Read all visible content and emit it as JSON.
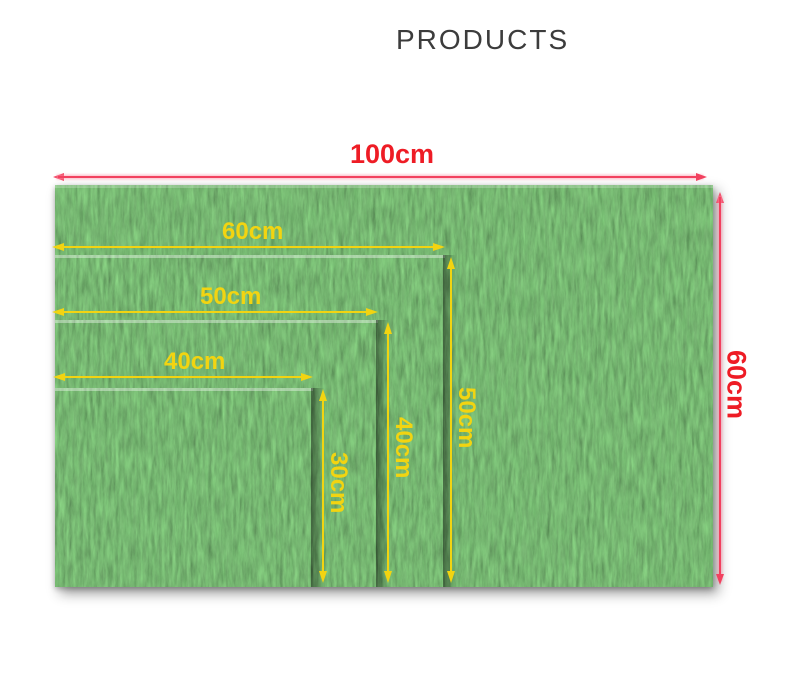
{
  "title": "PRODUCTS",
  "product": {
    "outer_mat": {
      "width_label": "100cm",
      "height_label": "60cm"
    },
    "inner_mats": [
      {
        "width_label": "60cm",
        "height_label": "50cm"
      },
      {
        "width_label": "50cm",
        "height_label": "40cm"
      },
      {
        "width_label": "40cm",
        "height_label": "30cm"
      }
    ]
  },
  "colors": {
    "title_text": "#3c3c3c",
    "outer_line": "#f2415f",
    "outer_text": "#ee1c25",
    "inner_line": "#f2d411",
    "inner_text": "#f2d411",
    "grass_green": "#2f6b2a"
  }
}
